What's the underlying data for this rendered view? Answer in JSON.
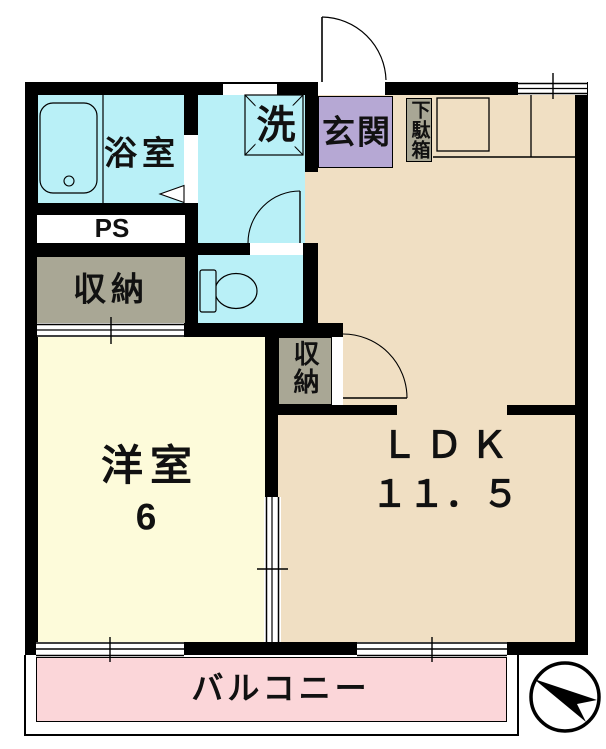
{
  "page": {
    "type": "apartment-floor-plan"
  },
  "rooms": {
    "bathroom": {
      "label": "浴室"
    },
    "washroom": {
      "washer_label": "洗"
    },
    "entrance": {
      "label": "玄関"
    },
    "shoe_cabinet": {
      "label": "下駄箱"
    },
    "pipe_space": {
      "label": "PS"
    },
    "storage_hall": {
      "label": "収納"
    },
    "storage_ldk": {
      "label": "収納"
    },
    "western_room": {
      "label": "洋室",
      "size": "6"
    },
    "ldk": {
      "label": "ＬＤＫ",
      "size": "１１．５"
    },
    "balcony": {
      "label": "バルコニー"
    }
  },
  "fixtures": {
    "bathtub": "bathtub-icon",
    "washer_pan": "washing-machine-pan-icon",
    "toilet": "toilet-icon",
    "kitchen_counter": "kitchen-counter-icon",
    "entrance_door": "door-swing-icon",
    "compass": "north-arrow-icon"
  },
  "colors": {
    "wall": "#000000",
    "wet_area_cyan": "#b9f0f7",
    "entrance_purple": "#b6a8d4",
    "ldk_tan": "#f0dfc3",
    "western_room_cream": "#fdfbda",
    "storage_gray": "#a9a795",
    "balcony_pink": "#fbd6d9"
  },
  "compass": {
    "points": "north-west"
  }
}
